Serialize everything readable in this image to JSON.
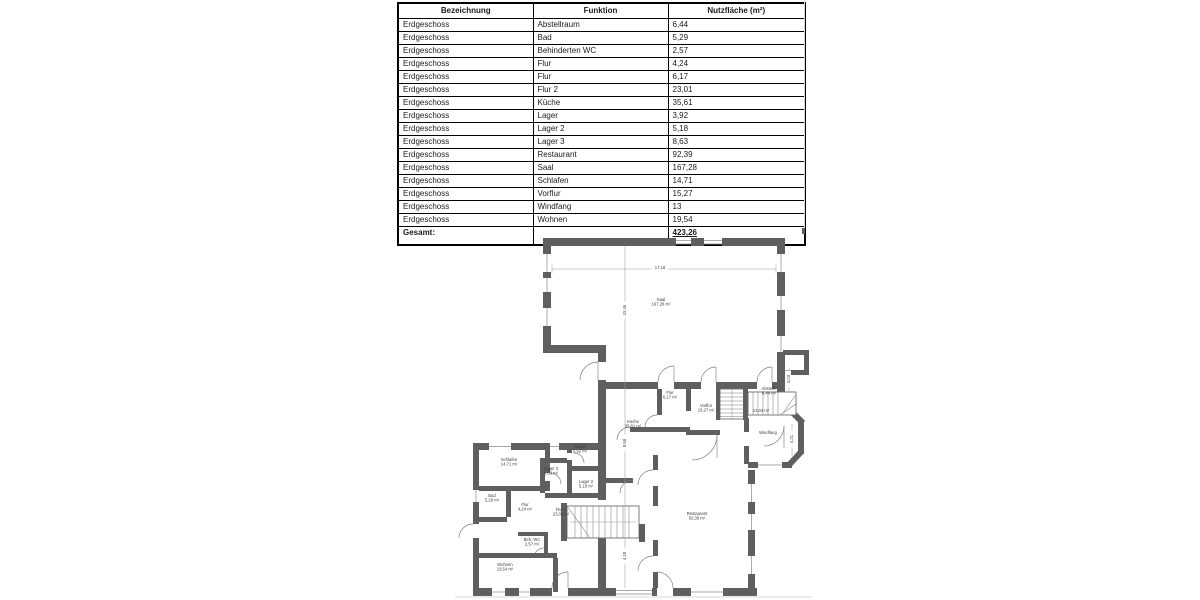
{
  "table": {
    "headers": [
      "Bezeichnung",
      "Funktion",
      "Nutzfläche (m²)"
    ],
    "rows": [
      {
        "bezeichnung": "Erdgeschoss",
        "funktion": "Abstellraum",
        "flaeche": "6,44"
      },
      {
        "bezeichnung": "Erdgeschoss",
        "funktion": "Bad",
        "flaeche": "5,29"
      },
      {
        "bezeichnung": "Erdgeschoss",
        "funktion": "Behinderten WC",
        "flaeche": "2,57"
      },
      {
        "bezeichnung": "Erdgeschoss",
        "funktion": "Flur",
        "flaeche": "4,24"
      },
      {
        "bezeichnung": "Erdgeschoss",
        "funktion": "Flur",
        "flaeche": "6,17"
      },
      {
        "bezeichnung": "Erdgeschoss",
        "funktion": "Flur 2",
        "flaeche": "23,01"
      },
      {
        "bezeichnung": "Erdgeschoss",
        "funktion": "Küche",
        "flaeche": "35,61"
      },
      {
        "bezeichnung": "Erdgeschoss",
        "funktion": "Lager",
        "flaeche": "3,92"
      },
      {
        "bezeichnung": "Erdgeschoss",
        "funktion": "Lager 2",
        "flaeche": "5,18"
      },
      {
        "bezeichnung": "Erdgeschoss",
        "funktion": "Lager 3",
        "flaeche": "8,63"
      },
      {
        "bezeichnung": "Erdgeschoss",
        "funktion": "Restaurant",
        "flaeche": "92,39"
      },
      {
        "bezeichnung": "Erdgeschoss",
        "funktion": "Saal",
        "flaeche": "167,28"
      },
      {
        "bezeichnung": "Erdgeschoss",
        "funktion": "Schlafen",
        "flaeche": "14,71"
      },
      {
        "bezeichnung": "Erdgeschoss",
        "funktion": "Vorflur",
        "flaeche": "15,27"
      },
      {
        "bezeichnung": "Erdgeschoss",
        "funktion": "Windfang",
        "flaeche": "13"
      },
      {
        "bezeichnung": "Erdgeschoss",
        "funktion": "Wohnen",
        "flaeche": "19,54"
      }
    ],
    "total_label": "Gesamt:",
    "total_value": "423,26"
  },
  "plan": {
    "wall_color": "#5f5f5f",
    "rooms": [
      {
        "name": "Saal",
        "area": "167,28 m²",
        "x": 661,
        "y": 301
      },
      {
        "name": "Flur",
        "area": "6,17 m²",
        "x": 670,
        "y": 394
      },
      {
        "name": "Vorflur",
        "area": "15,27 m²",
        "x": 706,
        "y": 407
      },
      {
        "name": "Küche",
        "area": "35,61 m²",
        "x": 633,
        "y": 423
      },
      {
        "name": "Abstellr.",
        "area": "6,44 m²",
        "x": 769,
        "y": 390
      },
      {
        "name": "",
        "area": "13,03 m²",
        "x": 761,
        "y": 412
      },
      {
        "name": "Windfang",
        "area": "",
        "x": 768,
        "y": 434
      },
      {
        "name": "Restaurant",
        "area": "92,39 m²",
        "x": 697,
        "y": 515
      },
      {
        "name": "Schlafen",
        "area": "14,71 m²",
        "x": 509,
        "y": 461
      },
      {
        "name": "Lager",
        "area": "3,92 m²",
        "x": 580,
        "y": 448
      },
      {
        "name": "Lager 3",
        "area": "8,63 m²",
        "x": 551,
        "y": 470
      },
      {
        "name": "Lager 2",
        "area": "5,18 m²",
        "x": 586,
        "y": 483
      },
      {
        "name": "Bad",
        "area": "5,29 m²",
        "x": 492,
        "y": 497
      },
      {
        "name": "Flur",
        "area": "4,24 m²",
        "x": 525,
        "y": 506
      },
      {
        "name": "Flur 2",
        "area": "23,01 m²",
        "x": 561,
        "y": 511
      },
      {
        "name": "Beh. WC",
        "area": "2,57 m²",
        "x": 532,
        "y": 541
      },
      {
        "name": "Wohnen",
        "area": "19,54 m²",
        "x": 505,
        "y": 566
      }
    ],
    "dimensions": [
      {
        "text": "17,18",
        "x": 660,
        "y": 268,
        "rot": 0
      },
      {
        "text": "15,46",
        "x": 625,
        "y": 310,
        "rot": -90
      },
      {
        "text": "8,68",
        "x": 625,
        "y": 443,
        "rot": -90
      },
      {
        "text": "4,18",
        "x": 625,
        "y": 556,
        "rot": -90
      },
      {
        "text": "3,03",
        "x": 789,
        "y": 379,
        "rot": -90
      },
      {
        "text": "4,21",
        "x": 792,
        "y": 439,
        "rot": -90
      }
    ]
  }
}
